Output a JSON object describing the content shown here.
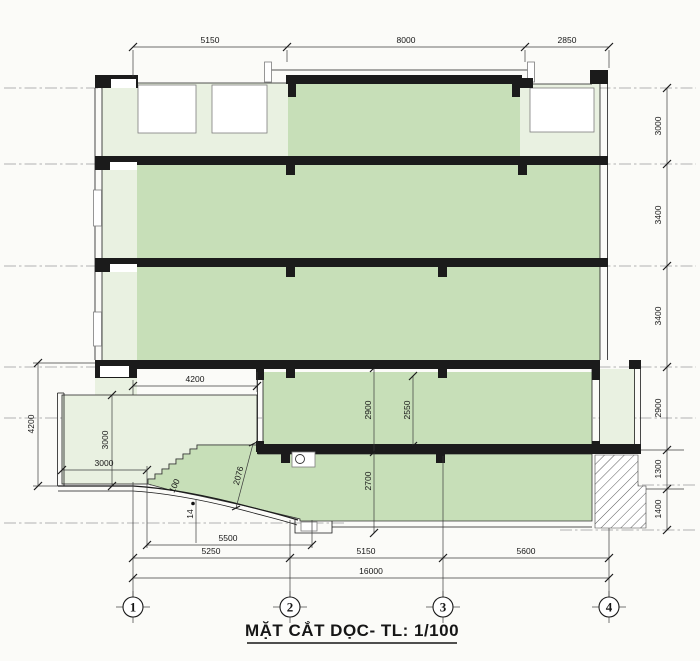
{
  "title": "MẶT CẮT DỌC- TL: 1/100",
  "grid_bubbles": [
    "1",
    "2",
    "3",
    "4"
  ],
  "dimensions": {
    "top_row": [
      "5150",
      "8000",
      "2850"
    ],
    "right_column": [
      "3000",
      "3400",
      "3400",
      "2900",
      "1300",
      "1400"
    ],
    "left_height": "4200",
    "entry_height": "3000",
    "entry_width": "3000",
    "canopy_width": "4200",
    "floor1_height": "2900",
    "floor1_clear": "2550",
    "basement_height": "2700",
    "ramp_slope_length": "2076",
    "ramp_note": "100",
    "step_note": "14",
    "ramp_run": "5500",
    "bottom_bays": [
      "5250",
      "5150",
      "5600"
    ],
    "total_width": "16000"
  },
  "colors": {
    "background": "#fbfbf8",
    "room": "#c7dfb8",
    "lite": "#e9f1e1",
    "line": "#1b1b1b",
    "dim": "#3c3c3c",
    "centerline": "#9b9b9b",
    "frame": "#7d7d7d",
    "text": "#161616"
  }
}
